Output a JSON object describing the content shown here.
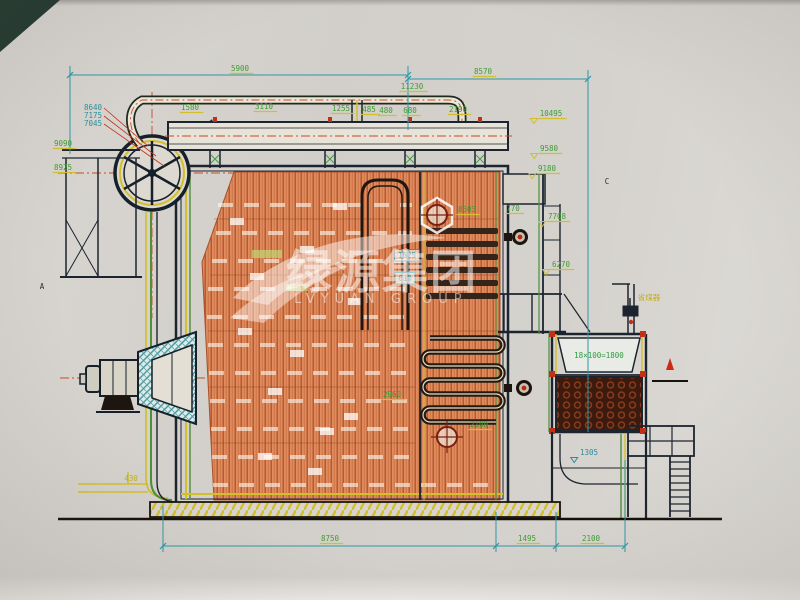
{
  "doc": {
    "type": "boiler-assembly-engineering-drawing",
    "view": "side-section"
  },
  "watermark": {
    "cn": "绿源集团",
    "en": "LVYUAN GROUP"
  },
  "colors": {
    "paper": "#d5d2cd",
    "line_dark": "#1c2430",
    "dim_teal": "#2e97a5",
    "dim_green": "#3e9d33",
    "underline_yellow": "#d2bf2a",
    "centerline_red": "#c94a22",
    "waterwall_orange": "#dd8a62",
    "econ_tube_brown": "#3c1b0e",
    "burner_teal": "#4f9aa0"
  },
  "labels": [
    {
      "t": "5900",
      "x": 240,
      "y": 71,
      "c": "g",
      "u": 1
    },
    {
      "t": "8570",
      "x": 483,
      "y": 74,
      "c": "g",
      "u": 1
    },
    {
      "t": "11230",
      "x": 412,
      "y": 89,
      "c": "g",
      "u": 1
    },
    {
      "t": "1580",
      "x": 190,
      "y": 110,
      "c": "g",
      "u": 1
    },
    {
      "t": "3110",
      "x": 264,
      "y": 109,
      "c": "g",
      "u": 1
    },
    {
      "t": "1255",
      "x": 341,
      "y": 111,
      "c": "g",
      "u": 1
    },
    {
      "t": "485",
      "x": 369,
      "y": 112,
      "c": "g",
      "u": 1
    },
    {
      "t": "480",
      "x": 386,
      "y": 113,
      "c": "g",
      "u": 1
    },
    {
      "t": "680",
      "x": 410,
      "y": 113,
      "c": "g",
      "u": 1
    },
    {
      "t": "2190",
      "x": 458,
      "y": 112,
      "c": "g",
      "u": 1
    },
    {
      "t": "10495",
      "x": 551,
      "y": 116,
      "c": "g",
      "u": 1,
      "d": 1
    },
    {
      "t": "9580",
      "x": 549,
      "y": 151,
      "c": "g",
      "u": 1,
      "d": 1
    },
    {
      "t": "9180",
      "x": 547,
      "y": 171,
      "c": "g",
      "u": 1,
      "d": 1
    },
    {
      "t": "770",
      "x": 513,
      "y": 211,
      "c": "g",
      "u": 1
    },
    {
      "t": "7708",
      "x": 557,
      "y": 219,
      "c": "g",
      "u": 1,
      "d": 1
    },
    {
      "t": "6270",
      "x": 561,
      "y": 267,
      "c": "g",
      "u": 1,
      "d": 1
    },
    {
      "t": "8603",
      "x": 467,
      "y": 212,
      "c": "g",
      "u": 1
    },
    {
      "t": "2960",
      "x": 392,
      "y": 397,
      "c": "g",
      "u": 1
    },
    {
      "t": "2100",
      "x": 479,
      "y": 427,
      "c": "g",
      "u": 1
    },
    {
      "t": "8750",
      "x": 330,
      "y": 541,
      "c": "g",
      "u": 1
    },
    {
      "t": "1495",
      "x": 527,
      "y": 541,
      "c": "g",
      "u": 1
    },
    {
      "t": "2100",
      "x": 591,
      "y": 541,
      "c": "g",
      "u": 1
    },
    {
      "t": "430",
      "x": 131,
      "y": 481,
      "c": "y"
    },
    {
      "t": "8640",
      "x": 93,
      "y": 110,
      "c": "t"
    },
    {
      "t": "7175",
      "x": 93,
      "y": 118,
      "c": "t"
    },
    {
      "t": "7045",
      "x": 93,
      "y": 126,
      "c": "t"
    },
    {
      "t": "9090",
      "x": 63,
      "y": 146,
      "c": "g",
      "u": 1
    },
    {
      "t": "8925",
      "x": 63,
      "y": 170,
      "c": "g",
      "u": 1
    },
    {
      "t": "1305",
      "x": 589,
      "y": 455,
      "c": "t",
      "d": 1
    },
    {
      "t": "1625",
      "x": 407,
      "y": 258,
      "c": "t",
      "b": 1
    },
    {
      "t": "610",
      "x": 405,
      "y": 281,
      "c": "t",
      "b": 1
    },
    {
      "t": "A",
      "x": 42,
      "y": 289,
      "c": "k",
      "s": 9
    },
    {
      "t": "C",
      "x": 607,
      "y": 184,
      "c": "k",
      "s": 9
    },
    {
      "t": "省煤器",
      "x": 649,
      "y": 300,
      "c": "y",
      "s": 9
    },
    {
      "t": "18×100=1800",
      "x": 599,
      "y": 358,
      "c": "g2",
      "s": 6.5
    }
  ]
}
